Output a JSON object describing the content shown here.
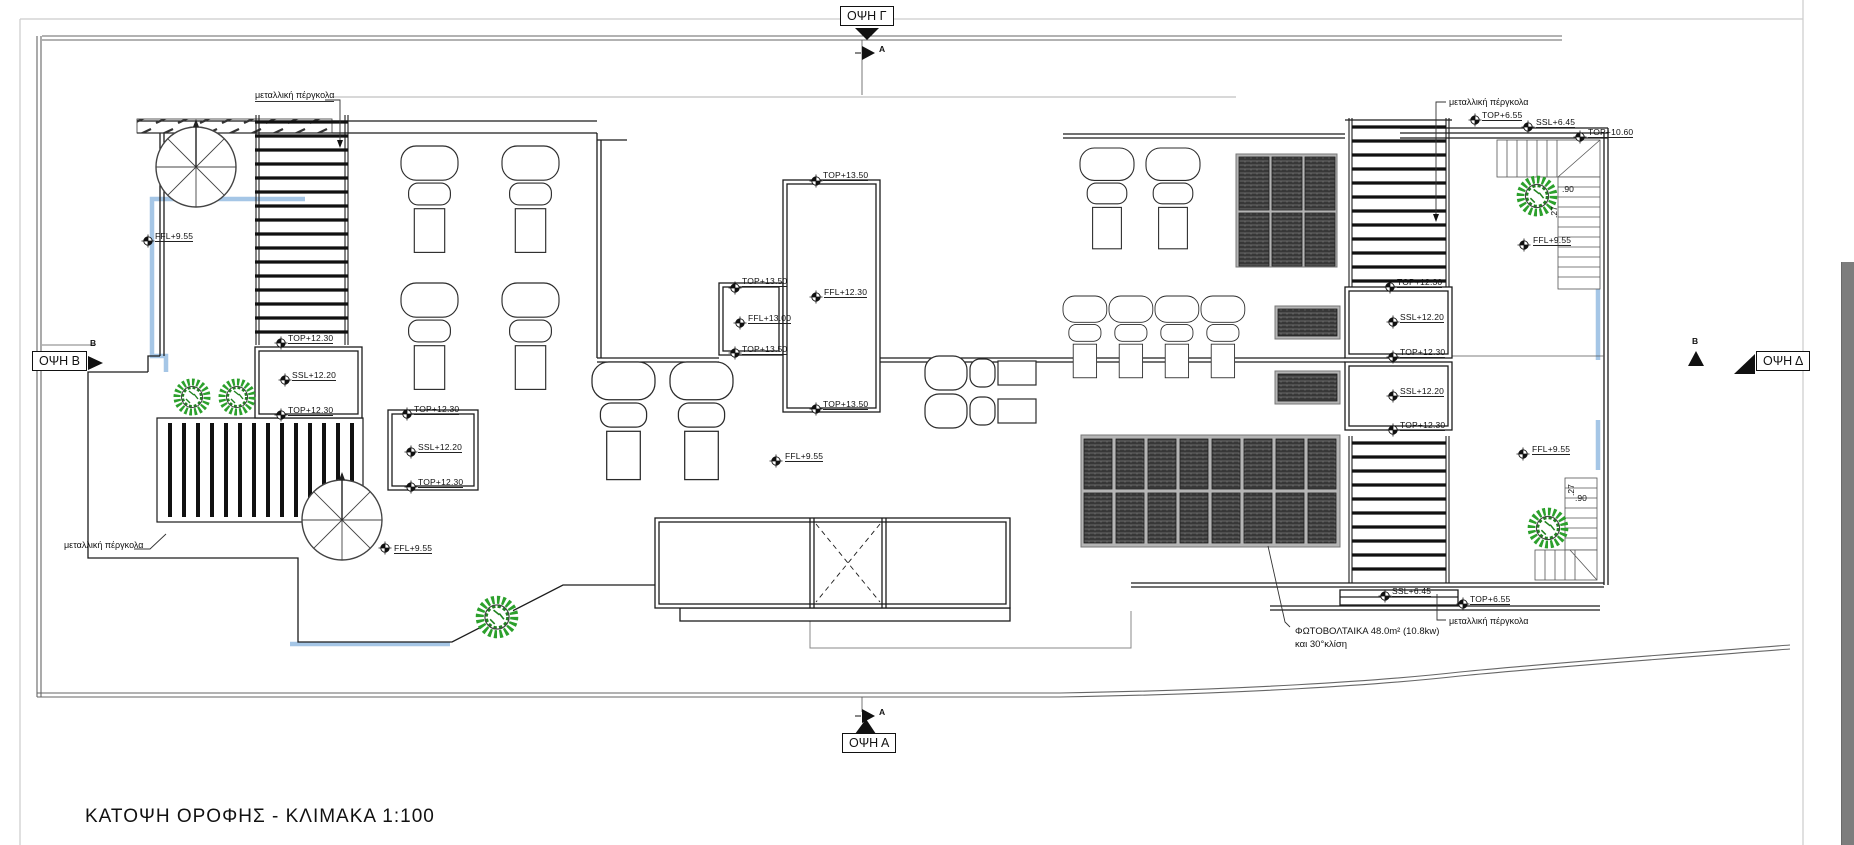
{
  "title": "ΚΑΤΟΨΗ ΟΡΟΦΗΣ - ΚΛΙΜΑΚΑ 1:100",
  "views": {
    "top": "ΟΨΗ Γ",
    "bottom": "ΟΨΗ Α",
    "left": "ΟΨΗ Β",
    "right": "ΟΨΗ Δ",
    "section_a": "A",
    "section_b": "B"
  },
  "levels": [
    "FFL+9.55",
    "TOP+12.30",
    "SSL+12.20",
    "TOP+12.30",
    "TOP+12.30",
    "SSL+12.20",
    "TOP+12.30",
    "TOP+13.50",
    "FFL+13.00",
    "TOP+13.50",
    "TOP+13.50",
    "FFL+12.30",
    "TOP+13.50",
    "FFL+9.55",
    "FFL+9.55",
    "TOP+12.30",
    "SSL+12.20",
    "TOP+12.30",
    "SSL+12.20",
    "TOP+12.30",
    "TOP+6.55",
    "SSL+6.45",
    "TOP+10.60",
    "FFL+9.55",
    "FFL+9.55",
    "SSL+6.45",
    "TOP+6.55"
  ],
  "annotations": {
    "pergola": "μεταλλική πέργκολα",
    "photovoltaics_line1": "ΦΩΤΟΒΟΛΤΑΙΚΑ 48.0m² (10.8kw)",
    "photovoltaics_line2": "και 30°κλίση",
    "dim_90": ".90",
    "dim_27": ".27"
  },
  "colors": {
    "wall": "#1c1c1c",
    "site_boundary": "#666666",
    "sheet_edge": "#cccccc",
    "highlight_blue": "#a5c6e6",
    "tree_green": "#2ca02c",
    "panel_dark": "#3f3f3f",
    "scrollbar_gray": "#7d7d7d"
  }
}
